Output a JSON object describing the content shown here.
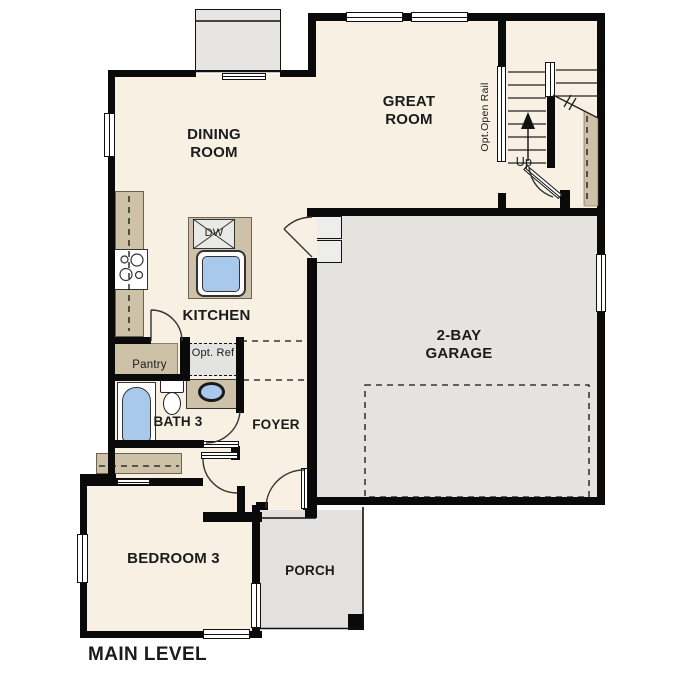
{
  "plan": {
    "level_label": "MAIN LEVEL",
    "rooms": {
      "dining": "DINING ROOM",
      "great": "GREAT ROOM",
      "kitchen": "KITCHEN",
      "garage": "2-BAY GARAGE",
      "bath": "BATH 3",
      "foyer": "FOYER",
      "bedroom": "BEDROOM 3",
      "porch": "PORCH",
      "pantry": "Pantry"
    },
    "features": {
      "opt_ref": "Opt. Ref",
      "dishwasher": "DW",
      "stairs_up": "Up",
      "opt_open_rail": "Opt.Open Rail"
    },
    "colors": {
      "floor": "#f7f0e3",
      "garage_floor": "#e4e3e0",
      "cabinet_tan": "#cdc1a8",
      "fixture_blue": "#a9c9ec",
      "wall": "#0a0a0a"
    }
  }
}
